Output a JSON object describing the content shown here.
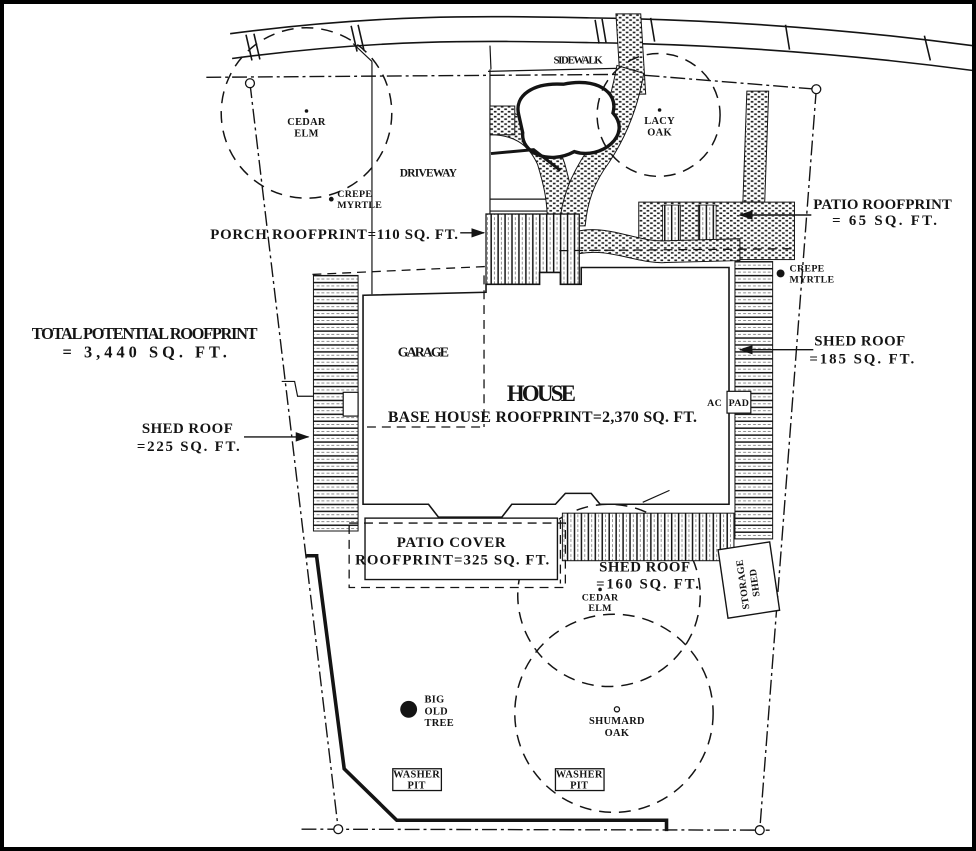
{
  "colors": {
    "ink": "#141414",
    "paper": "#ffffff"
  },
  "site": {
    "sidewalk_label": "SIDEWALK",
    "driveway_label": "DRIVEWAY"
  },
  "trees": {
    "cedar_elm_top": {
      "line1": "CEDAR",
      "line2": "ELM"
    },
    "lacy_oak": {
      "line1": "LACY",
      "line2": "OAK"
    },
    "crepe_myrtle_left": {
      "line1": "CREPE",
      "line2": "MYRTLE"
    },
    "crepe_myrtle_right": {
      "line1": "CREPE",
      "line2": "MYRTLE"
    },
    "cedar_elm_bottom": {
      "line1": "CEDAR",
      "line2": "ELM"
    },
    "big_old_tree": {
      "line1": "BIG",
      "line2": "OLD",
      "line3": "TREE"
    },
    "shumard_oak": {
      "line1": "SHUMARD",
      "line2": "OAK"
    }
  },
  "structures": {
    "garage_label": "GARAGE",
    "house_label": "HOUSE",
    "ac_pad": {
      "line1": "AC",
      "line2": "PAD"
    },
    "storage_shed": {
      "line1": "STORAGE",
      "line2": "SHED"
    },
    "washer_pit": {
      "line1": "WASHER",
      "line2": "PIT"
    }
  },
  "annotations": {
    "porch_roofprint": "PORCH ROOFPRINT=110 SQ. FT.",
    "base_house_roofprint": "BASE HOUSE ROOFPRINT=2,370 SQ. FT.",
    "total_roofprint": {
      "line1": "TOTAL POTENTIAL ROOFPRINT",
      "line2": "= 3,440 SQ. FT."
    },
    "patio_roofprint": {
      "line1": "PATIO ROOFPRINT",
      "line2": "= 65 SQ. FT."
    },
    "shed_roof_left": {
      "line1": "SHED ROOF",
      "line2": "=225 SQ. FT."
    },
    "shed_roof_right": {
      "line1": "SHED ROOF",
      "line2": "=185 SQ. FT."
    },
    "shed_roof_bottom": {
      "line1": "SHED ROOF",
      "line2": "=160 SQ. FT."
    },
    "patio_cover": {
      "line1": "PATIO COVER",
      "line2": "ROOFPRINT=325 SQ. FT."
    }
  }
}
